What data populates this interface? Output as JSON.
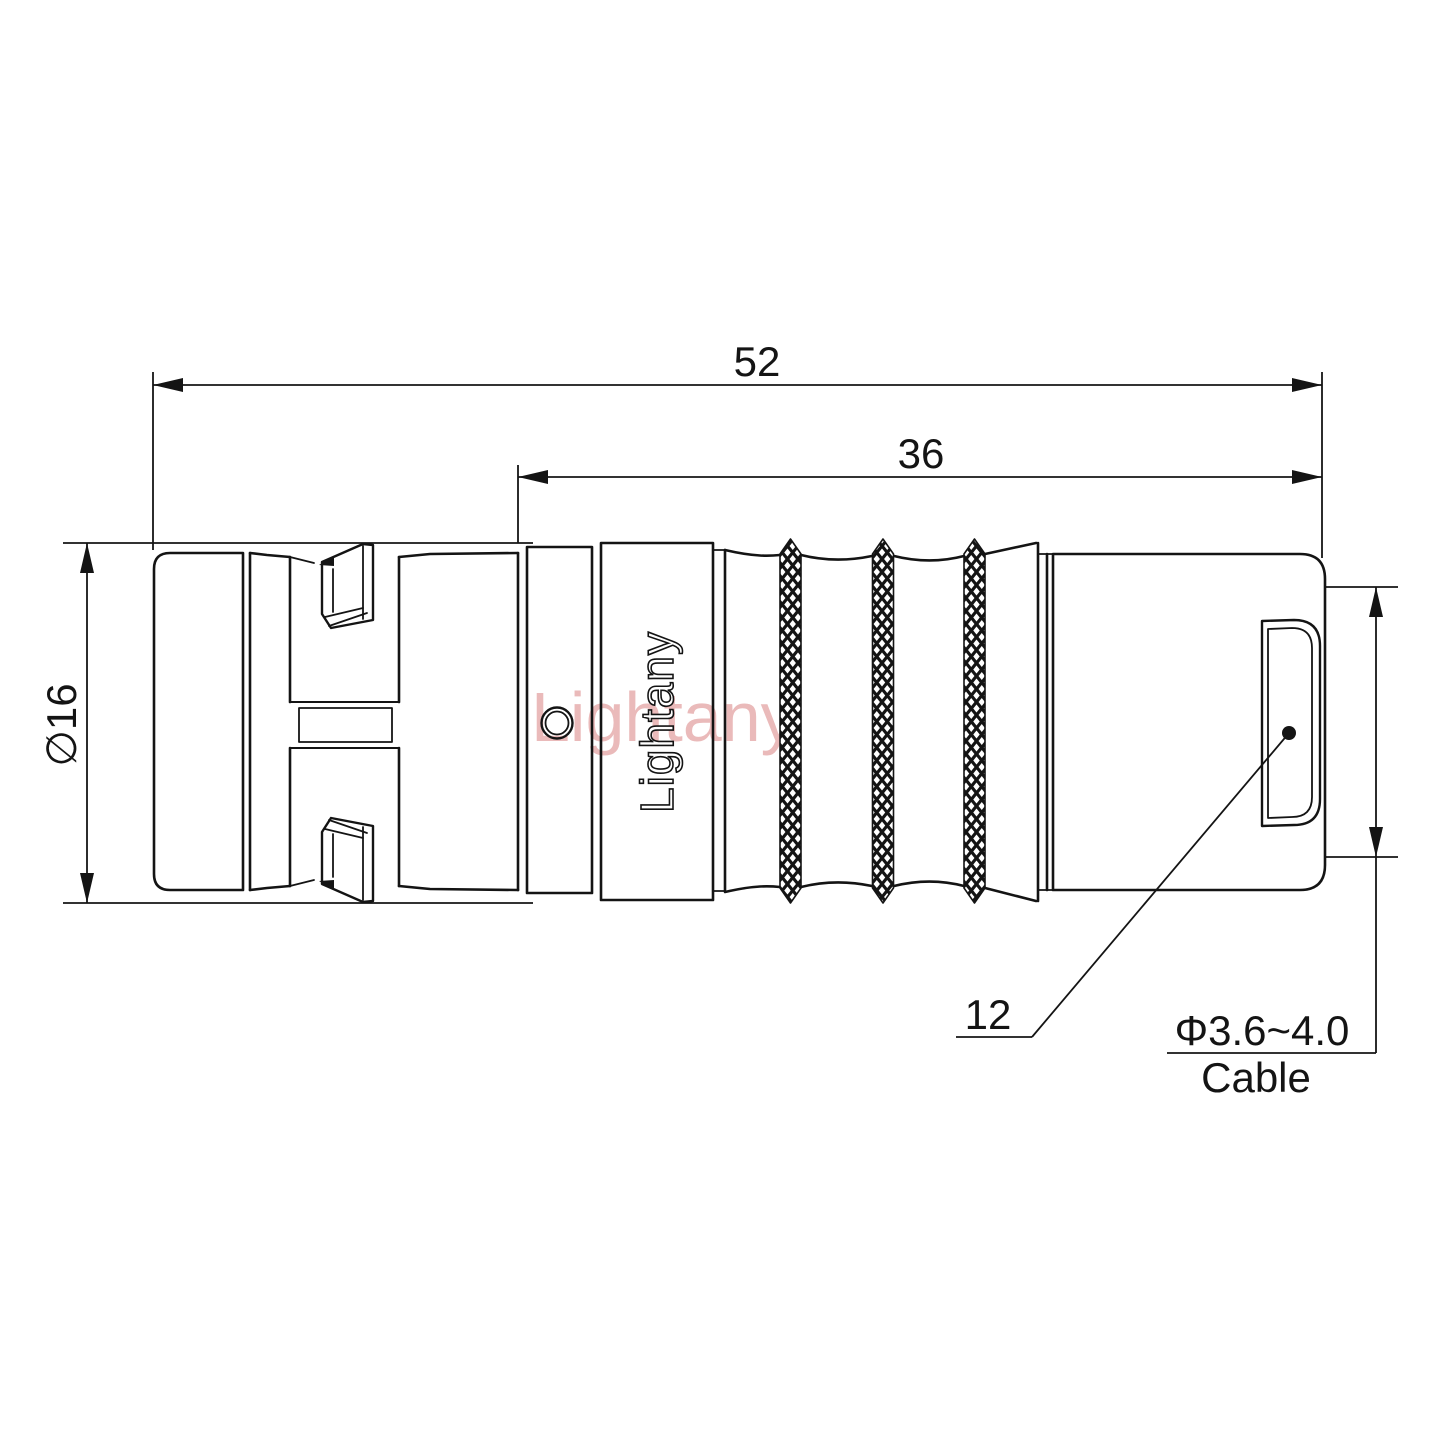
{
  "drawing": {
    "title": "connector-technical-drawing",
    "line_color": "#141414",
    "background": "#ffffff",
    "watermark": {
      "text": "Lightany",
      "color": "rgba(214,118,118,0.5)"
    },
    "engraving": {
      "text": "Lightany"
    },
    "dimensions": {
      "overall_length": "52",
      "body_length": "36",
      "shell_diameter": "∅16",
      "rear_face_height": "12",
      "cable_range": "Φ3.6~4.0",
      "cable_word": "Cable"
    }
  }
}
